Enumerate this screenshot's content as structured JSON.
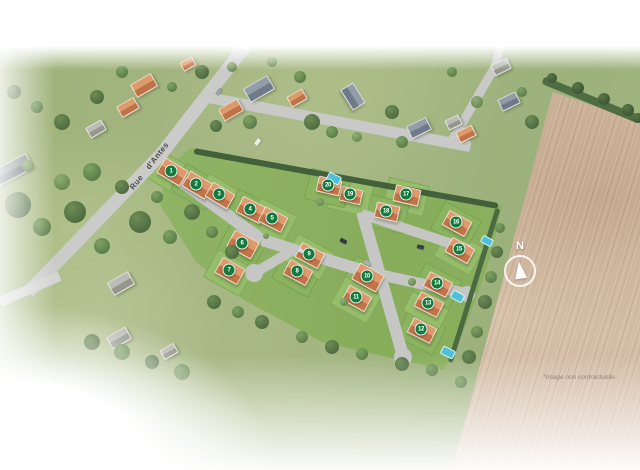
{
  "labels": {
    "street": "Rue d'Antes",
    "compass": "N",
    "disclaimer": "*Image non contractuelle"
  },
  "colors": {
    "marker_green": "#117a3c",
    "new_roof": "#d2824f",
    "lawn": "#8fb164",
    "road": "#c6c7c5",
    "field_tan": "#cbb096",
    "pool_blue": "#4ec0da",
    "hedge_dark": "#42603a"
  },
  "lots": [
    {
      "num": "1",
      "x": 171,
      "y": 171,
      "rot": 31,
      "w": 25,
      "h": 16
    },
    {
      "num": "2",
      "x": 196,
      "y": 184,
      "rot": 31,
      "w": 25,
      "h": 16
    },
    {
      "num": "3",
      "x": 219,
      "y": 194,
      "rot": 31,
      "w": 24,
      "h": 15
    },
    {
      "num": "4",
      "x": 250,
      "y": 209,
      "rot": 27,
      "w": 25,
      "h": 16
    },
    {
      "num": "5",
      "x": 272,
      "y": 218,
      "rot": 27,
      "w": 24,
      "h": 15
    },
    {
      "num": "6",
      "x": 242,
      "y": 243,
      "rot": 29,
      "w": 26,
      "h": 17
    },
    {
      "num": "7",
      "x": 229,
      "y": 270,
      "rot": 29,
      "w": 24,
      "h": 16
    },
    {
      "num": "8",
      "x": 297,
      "y": 271,
      "rot": 28,
      "w": 24,
      "h": 15
    },
    {
      "num": "9",
      "x": 309,
      "y": 254,
      "rot": 28,
      "w": 24,
      "h": 15
    },
    {
      "num": "10",
      "x": 367,
      "y": 276,
      "rot": 29,
      "w": 26,
      "h": 17
    },
    {
      "num": "11",
      "x": 356,
      "y": 297,
      "rot": 29,
      "w": 24,
      "h": 15
    },
    {
      "num": "12",
      "x": 421,
      "y": 329,
      "rot": 27,
      "w": 24,
      "h": 15
    },
    {
      "num": "13",
      "x": 428,
      "y": 303,
      "rot": 27,
      "w": 24,
      "h": 15
    },
    {
      "num": "14",
      "x": 437,
      "y": 283,
      "rot": 27,
      "w": 24,
      "h": 15
    },
    {
      "num": "15",
      "x": 459,
      "y": 249,
      "rot": 29,
      "w": 24,
      "h": 15
    },
    {
      "num": "16",
      "x": 456,
      "y": 222,
      "rot": 29,
      "w": 24,
      "h": 15
    },
    {
      "num": "17",
      "x": 406,
      "y": 194,
      "rot": 13,
      "w": 24,
      "h": 15
    },
    {
      "num": "18",
      "x": 386,
      "y": 211,
      "rot": 13,
      "w": 22,
      "h": 14
    },
    {
      "num": "19",
      "x": 350,
      "y": 194,
      "rot": 13,
      "w": 20,
      "h": 13
    },
    {
      "num": "20",
      "x": 328,
      "y": 185,
      "rot": 13,
      "w": 22,
      "h": 14
    }
  ],
  "scene": {
    "roads": [
      {
        "x1": 252,
        "y1": 37,
        "x2": 160,
        "y2": 155,
        "w": 13,
        "c": "#cbccca",
        "name": "rue-dantes-road"
      },
      {
        "x1": 160,
        "y1": 155,
        "x2": 28,
        "y2": 292,
        "w": 13,
        "c": "#cbccca",
        "name": "rue-dantes-road"
      },
      {
        "x1": 208,
        "y1": 97,
        "x2": 470,
        "y2": 146,
        "w": 11,
        "c": "#c9cac8",
        "name": "village-road"
      },
      {
        "x1": 452,
        "y1": 140,
        "x2": 494,
        "y2": 68,
        "w": 9,
        "c": "#c9cac8",
        "name": "village-road"
      },
      {
        "x1": 494,
        "y1": 68,
        "x2": 514,
        "y2": 4,
        "w": 8,
        "c": "#c9cac8",
        "name": "village-road"
      },
      {
        "x1": 0,
        "y1": 302,
        "x2": 60,
        "y2": 276,
        "w": 10,
        "c": "#d3d4d2",
        "name": "village-road"
      },
      {
        "x1": 168,
        "y1": 172,
        "x2": 262,
        "y2": 240,
        "w": 12,
        "c": "#c6c7c5",
        "name": "site-road"
      },
      {
        "x1": 262,
        "y1": 240,
        "x2": 381,
        "y2": 276,
        "w": 12,
        "c": "#c6c7c5",
        "name": "site-road"
      },
      {
        "x1": 362,
        "y1": 212,
        "x2": 403,
        "y2": 356,
        "w": 12,
        "c": "#c6c7c5",
        "name": "site-road"
      },
      {
        "x1": 379,
        "y1": 274,
        "x2": 466,
        "y2": 293,
        "w": 11,
        "c": "#c6c7c5",
        "name": "site-road"
      },
      {
        "x1": 362,
        "y1": 214,
        "x2": 470,
        "y2": 250,
        "w": 10,
        "c": "#c6c7c5",
        "name": "site-road"
      },
      {
        "x1": 290,
        "y1": 252,
        "x2": 256,
        "y2": 272,
        "w": 10,
        "c": "#c6c7c5",
        "name": "site-road"
      }
    ],
    "bulbs": [
      [
        254,
        273,
        9
      ],
      [
        403,
        357,
        9
      ],
      [
        467,
        294,
        8
      ]
    ],
    "hedges": [
      {
        "x1": 194,
        "y1": 151,
        "x2": 498,
        "y2": 206,
        "w": 6,
        "c": "#42603a",
        "name": "north-hedge"
      },
      {
        "x1": 498,
        "y1": 208,
        "x2": 450,
        "y2": 362,
        "w": 5,
        "c": "#4a6a40",
        "name": "east-hedge"
      },
      {
        "x1": 543,
        "y1": 80,
        "x2": 640,
        "y2": 120,
        "w": 8,
        "c": "#4f6d43",
        "name": "field-tree-line"
      }
    ],
    "existing_houses": [
      [
        12,
        168,
        36,
        15,
        -28,
        "d"
      ],
      [
        95,
        128,
        16,
        10,
        -30,
        "g"
      ],
      [
        143,
        84,
        22,
        13,
        -30,
        "o"
      ],
      [
        127,
        106,
        18,
        11,
        -30,
        "o"
      ],
      [
        187,
        63,
        12,
        8,
        -30,
        "o"
      ],
      [
        230,
        109,
        20,
        12,
        -30,
        "o"
      ],
      [
        258,
        88,
        26,
        14,
        -30,
        "s"
      ],
      [
        296,
        97,
        16,
        10,
        -30,
        "o"
      ],
      [
        352,
        95,
        22,
        13,
        58,
        "s"
      ],
      [
        418,
        127,
        20,
        12,
        -26,
        "s"
      ],
      [
        452,
        121,
        13,
        9,
        -26,
        "g"
      ],
      [
        465,
        133,
        16,
        10,
        -26,
        "o"
      ],
      [
        508,
        100,
        18,
        11,
        -26,
        "s"
      ],
      [
        500,
        66,
        16,
        10,
        -26,
        "g"
      ],
      [
        560,
        20,
        14,
        9,
        -26,
        "g"
      ],
      [
        120,
        282,
        22,
        13,
        -30,
        "g"
      ],
      [
        118,
        337,
        20,
        12,
        -30,
        "g"
      ],
      [
        168,
        350,
        14,
        9,
        -30,
        "g"
      ]
    ],
    "pools": [
      [
        333,
        177,
        12,
        7,
        27
      ],
      [
        486,
        240,
        10,
        6,
        29
      ],
      [
        456,
        295,
        11,
        7,
        28
      ],
      [
        447,
        351,
        12,
        7,
        27
      ]
    ],
    "cars": [
      [
        257,
        142,
        -52,
        "#eceeee"
      ],
      [
        218,
        92,
        -52,
        "#99a1a8"
      ],
      [
        343,
        241,
        28,
        "#2f3945"
      ],
      [
        420,
        247,
        12,
        "#39424e"
      ],
      [
        301,
        251,
        28,
        "#d9dbdc"
      ],
      [
        367,
        263,
        28,
        "#aab0b5"
      ]
    ],
    "trees": [
      [
        18,
        205,
        13,
        0
      ],
      [
        42,
        227,
        9,
        1
      ],
      [
        75,
        212,
        11,
        0
      ],
      [
        102,
        246,
        8,
        1
      ],
      [
        140,
        222,
        11,
        0
      ],
      [
        170,
        237,
        7,
        1
      ],
      [
        62,
        182,
        8,
        2
      ],
      [
        92,
        172,
        9,
        1
      ],
      [
        122,
        187,
        7,
        0
      ],
      [
        157,
        197,
        6,
        1
      ],
      [
        192,
        212,
        8,
        0
      ],
      [
        212,
        232,
        6,
        1
      ],
      [
        232,
        252,
        7,
        0
      ],
      [
        28,
        166,
        6,
        2
      ],
      [
        250,
        122,
        7,
        1
      ],
      [
        216,
        126,
        6,
        0
      ],
      [
        312,
        122,
        8,
        0
      ],
      [
        332,
        132,
        6,
        1
      ],
      [
        392,
        112,
        7,
        0
      ],
      [
        402,
        142,
        6,
        1
      ],
      [
        357,
        137,
        5,
        2
      ],
      [
        300,
        77,
        6,
        1
      ],
      [
        202,
        72,
        7,
        0
      ],
      [
        172,
        87,
        5,
        1
      ],
      [
        232,
        67,
        5,
        2
      ],
      [
        122,
        72,
        6,
        1
      ],
      [
        97,
        97,
        7,
        0
      ],
      [
        62,
        122,
        8,
        0
      ],
      [
        37,
        107,
        6,
        1
      ],
      [
        14,
        92,
        7,
        0
      ],
      [
        272,
        62,
        5,
        2
      ],
      [
        452,
        72,
        5,
        1
      ],
      [
        477,
        102,
        6,
        2
      ],
      [
        532,
        122,
        7,
        0
      ],
      [
        522,
        92,
        5,
        1
      ],
      [
        552,
        78,
        5,
        3
      ],
      [
        578,
        88,
        6,
        3
      ],
      [
        604,
        99,
        6,
        3
      ],
      [
        628,
        110,
        6,
        3
      ],
      [
        638,
        118,
        5,
        3
      ],
      [
        500,
        228,
        5,
        1
      ],
      [
        497,
        252,
        6,
        0
      ],
      [
        491,
        277,
        6,
        1
      ],
      [
        485,
        302,
        7,
        0
      ],
      [
        477,
        332,
        6,
        1
      ],
      [
        469,
        357,
        7,
        0
      ],
      [
        461,
        382,
        6,
        1
      ],
      [
        214,
        302,
        7,
        0
      ],
      [
        238,
        312,
        6,
        1
      ],
      [
        262,
        322,
        7,
        0
      ],
      [
        302,
        337,
        6,
        1
      ],
      [
        332,
        347,
        7,
        0
      ],
      [
        362,
        354,
        6,
        1
      ],
      [
        402,
        364,
        7,
        0
      ],
      [
        432,
        370,
        6,
        1
      ],
      [
        320,
        202,
        4,
        2
      ],
      [
        266,
        236,
        3,
        2
      ],
      [
        412,
        282,
        4,
        2
      ],
      [
        344,
        302,
        4,
        2
      ],
      [
        182,
        372,
        8,
        1
      ],
      [
        152,
        362,
        7,
        0
      ],
      [
        122,
        352,
        8,
        1
      ],
      [
        92,
        342,
        8,
        0
      ]
    ]
  }
}
